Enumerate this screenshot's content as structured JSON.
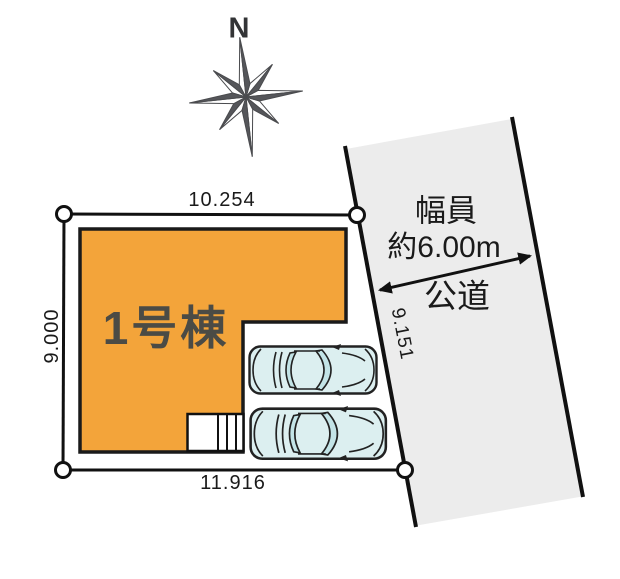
{
  "compass": {
    "north_label": "N"
  },
  "plot": {
    "dimensions": {
      "top": "10.254",
      "left": "9.000",
      "bottom": "11.916",
      "right": "9.151"
    }
  },
  "building": {
    "label": "1号棟"
  },
  "road": {
    "width_caption": "幅員",
    "width_value": "約6.00m",
    "name": "公道"
  },
  "colors": {
    "building_fill": "#F3A43A",
    "building_label": "#4B4B45",
    "road_fill": "#ECECEC",
    "car_body": "#DCEFF0",
    "car_glass": "#C3E4E7",
    "outline": "#1A1A1A",
    "compass": "#55565A"
  }
}
